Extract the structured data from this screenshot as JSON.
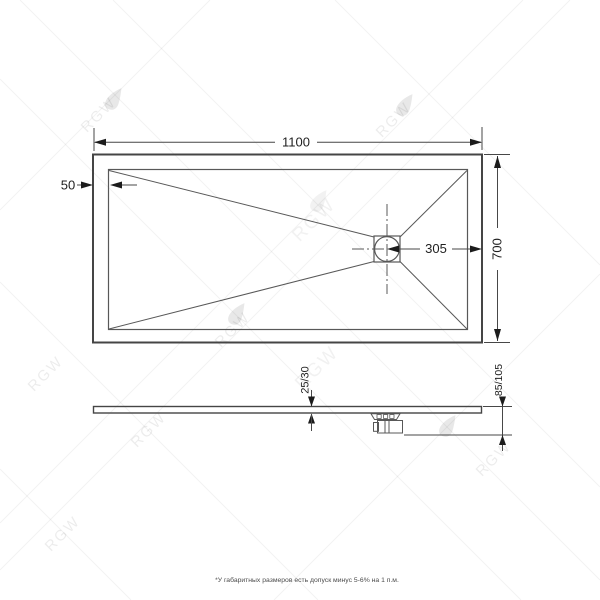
{
  "watermark": {
    "brand": "RGW"
  },
  "dimensions": {
    "length": "1100",
    "width": "700",
    "edge_offset": "50",
    "drain_offset": "305",
    "thickness": "25/30",
    "height": "85/105"
  },
  "footnote": "*У габаритных размеров есть допуск минус 5-6% на 1 п.м.",
  "colors": {
    "line": "#454545",
    "dim_text": "#1f1f1f",
    "watermark": "#ebebeb"
  }
}
